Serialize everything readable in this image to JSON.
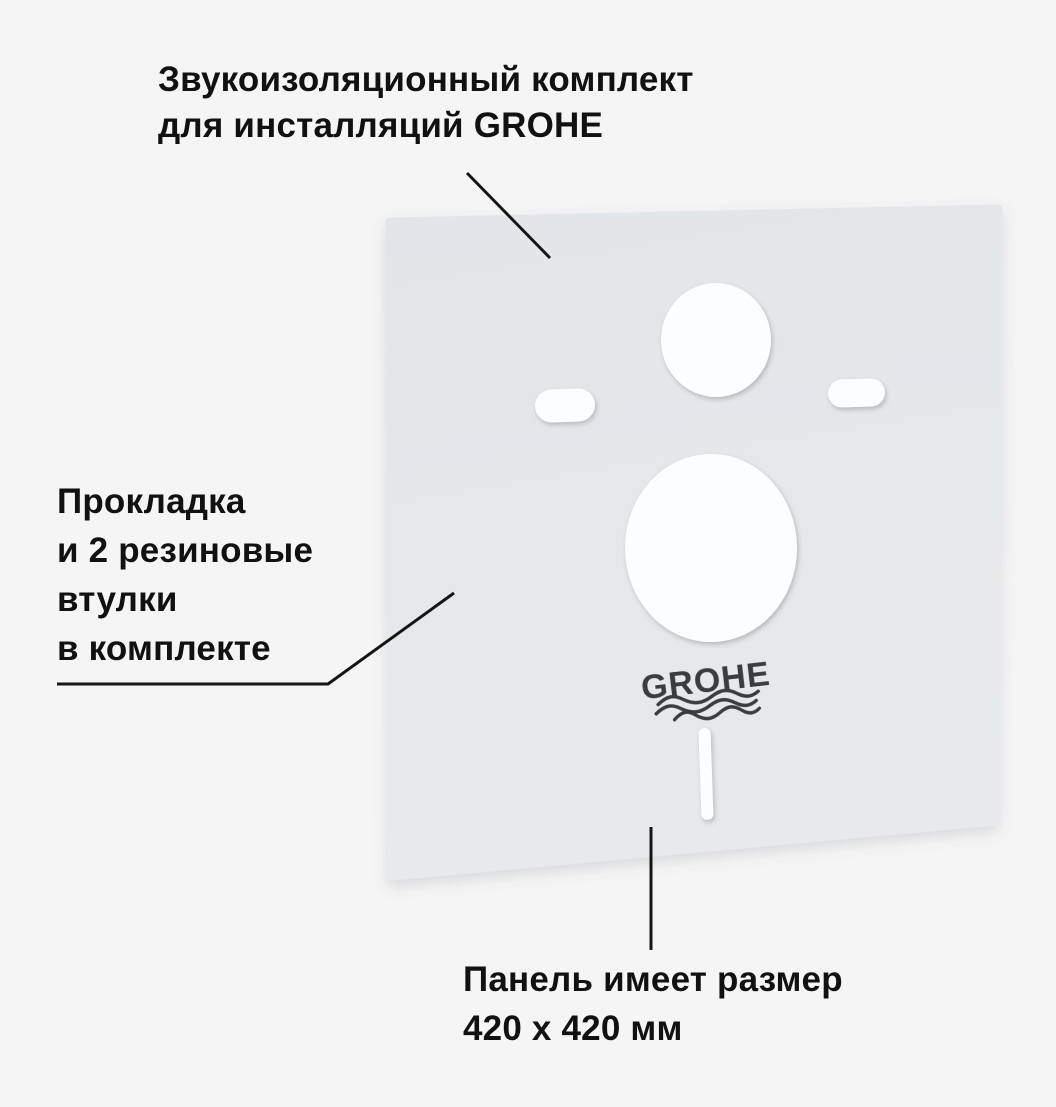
{
  "image_title": "Звукоизоляционный комплект для инсталляций GROHE",
  "background_color": "#f5f5f6",
  "text_color": "#111111",
  "callout_line_color": "#151515",
  "panel": {
    "description": "sound-insulation-panel",
    "surface_color_top": "#e3e6e8",
    "surface_color_bottom": "#e7e9ea",
    "cutout_color": "#fcfdfe",
    "logo": {
      "text": "GROHE",
      "color": "#3a3d3f"
    }
  },
  "annotations": {
    "top": {
      "lines": [
        "Звукоизоляционный комплект",
        "для инсталляций GROHE"
      ]
    },
    "left": {
      "lines": [
        "Прокладка",
        "и 2 резиновые",
        "втулки",
        "в комплекте"
      ]
    },
    "bottom": {
      "lines": [
        "Панель имеет размер",
        "420 x 420 мм"
      ]
    }
  }
}
